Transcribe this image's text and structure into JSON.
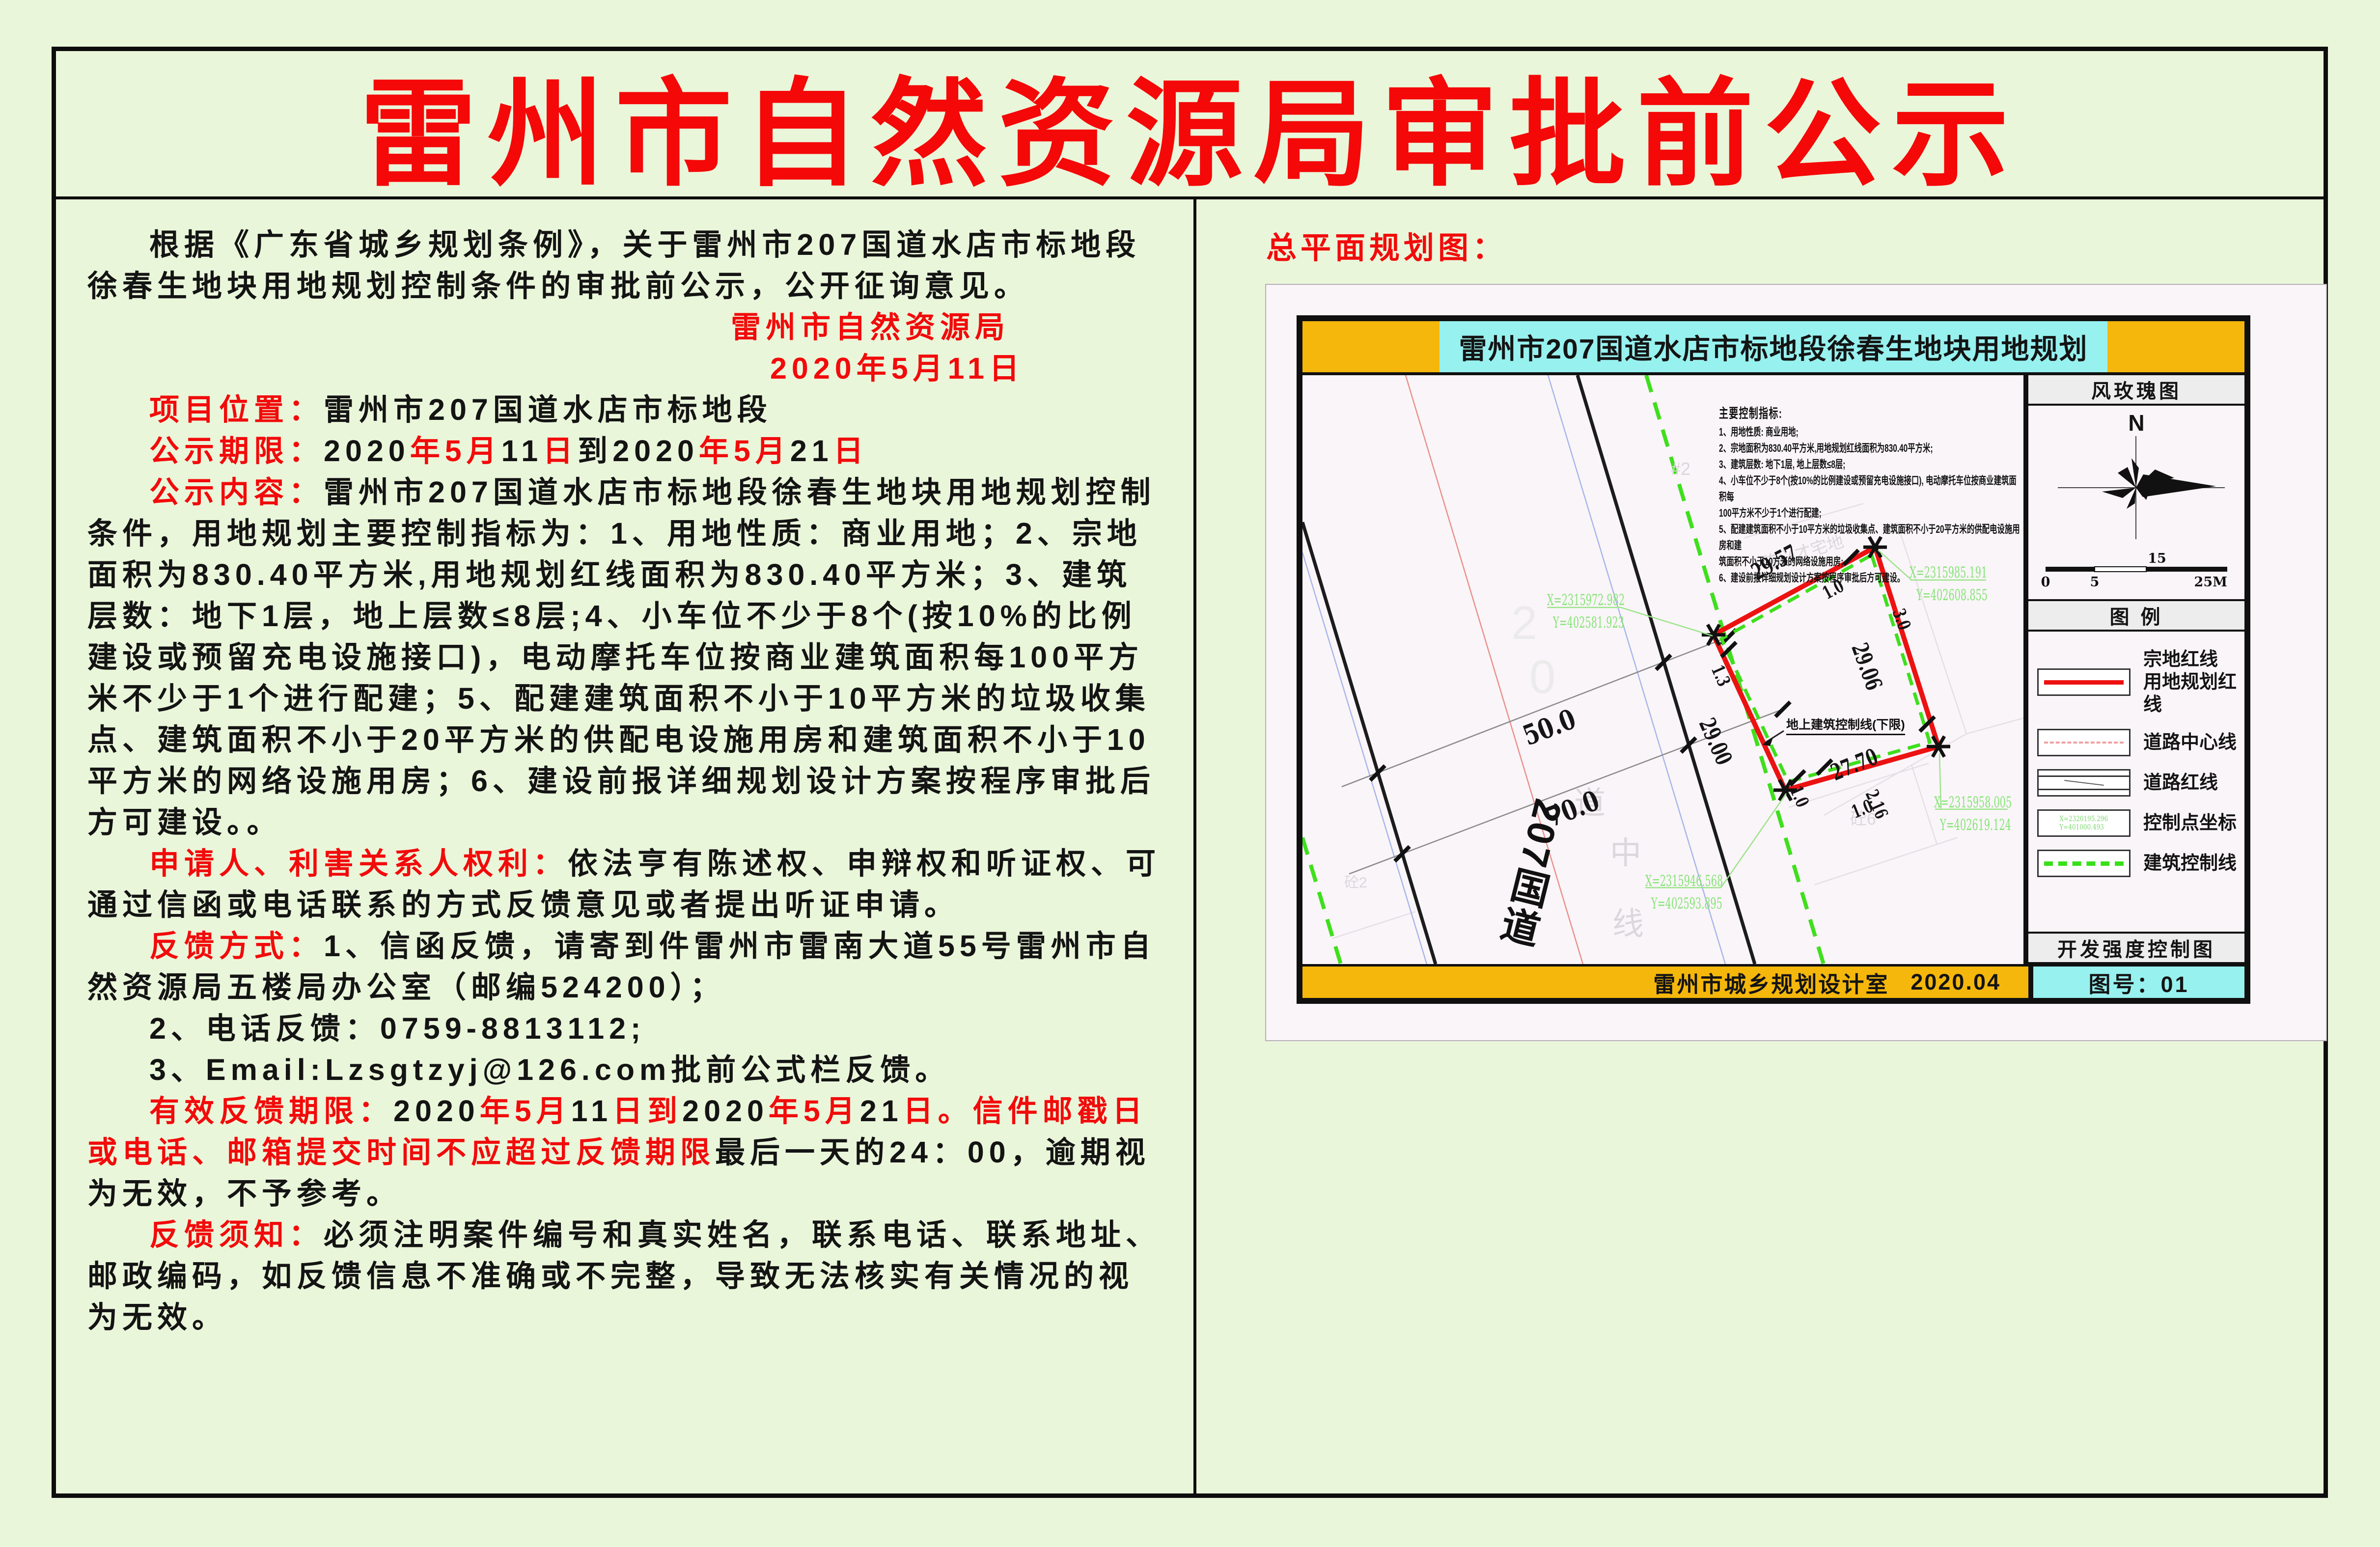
{
  "page": {
    "bg": "#eaf6da",
    "red": "#f20b0b",
    "title": "雷州市自然资源局审批前公示"
  },
  "left": {
    "p1": [
      {
        "t": "根据《广东省城乡规划条例》，关于雷州市207国道水店市标地段徐春生地块用地规划控制条件的审批前公示，公开征询意见。"
      }
    ],
    "sign1": [
      {
        "t": "雷州市自然资源局",
        "c": "r"
      }
    ],
    "sign2": [
      {
        "t": "2020年5月11日",
        "c": "r"
      }
    ],
    "p_location": [
      {
        "t": "项目位置：",
        "c": "r"
      },
      {
        "t": "雷州市207国道水店市标地段"
      }
    ],
    "p_period": [
      {
        "t": "公示期限：",
        "c": "r"
      },
      {
        "t": "2020"
      },
      {
        "t": "年5月",
        "c": "r"
      },
      {
        "t": "11"
      },
      {
        "t": "日",
        "c": "r"
      },
      {
        "t": "到"
      },
      {
        "t": "2020"
      },
      {
        "t": "年5月",
        "c": "r"
      },
      {
        "t": "21"
      },
      {
        "t": "日",
        "c": "r"
      }
    ],
    "p_content": [
      {
        "t": "公示内容：",
        "c": "r"
      },
      {
        "t": "雷州市207国道水店市标地段徐春生地块用地规划控制条件，用地规划主要控制指标为：1、用地性质：商业用地；2、宗地面积为830.40平方米,用地规划红线面积为830.40平方米；3、建筑层数：地下1层，地上层数≤8层;4、小车位不少于8个(按10%的比例建设或预留充电设施接口)，电动摩托车位按商业建筑面积每100平方米不少于1个进行配建；5、配建建筑面积不小于10平方米的垃圾收集点、建筑面积不小于20平方米的供配电设施用房和建筑面积不小于10平方米的网络设施用房；6、建设前报详细规划设计方案按程序审批后方可建设。。"
      }
    ],
    "p_rights": [
      {
        "t": "申请人、利害关系人权利：",
        "c": "r"
      },
      {
        "t": "依法亨有陈述权、申辩权和听证权、可通过信函或电话联系的方式反馈意见或者提出听证申请。"
      }
    ],
    "p_feedback": [
      {
        "t": "反馈方式：",
        "c": "r"
      },
      {
        "t": "1、信函反馈，请寄到件雷州市雷南大道55号雷州市自然资源局五楼局办公室（邮编524200）；"
      }
    ],
    "p_phone": [
      {
        "t": "2、电话反馈：0759-8813112;"
      }
    ],
    "p_email": [
      {
        "t": "3、Email:Lzsgtzyj@126.com批前公式栏反馈。"
      }
    ],
    "p_deadline": [
      {
        "t": "有效反馈期限：",
        "c": "r"
      },
      {
        "t": "2020"
      },
      {
        "t": "年5月",
        "c": "r"
      },
      {
        "t": "11"
      },
      {
        "t": "日到",
        "c": "r"
      },
      {
        "t": "2020"
      },
      {
        "t": "年5月",
        "c": "r"
      },
      {
        "t": "21"
      },
      {
        "t": "日。信件邮戳日或电话、邮箱提交时间不应超过反馈期限",
        "c": "r"
      },
      {
        "t": "最后一天的24：00，逾期视为无效，不予参考。"
      }
    ],
    "p_notice": [
      {
        "t": "反馈须知：",
        "c": "r"
      },
      {
        "t": "必须注明案件编号和真实姓名，联系电话、联系地址、邮政编码，如反馈信息不准确或不完整，导致无法核实有关情况的视为无效。"
      }
    ]
  },
  "map": {
    "section_title": "总平面规划图：",
    "title": "雷州市207国道水店市标地段徐春生地块用地规划",
    "footer": {
      "org": "雷州市城乡规划设计室",
      "date": "2020.04"
    },
    "sidebar": {
      "windrose_title": "风玫瑰图",
      "north": "N",
      "scale_labels": [
        "0",
        "5",
        "15",
        "25M"
      ],
      "legend_title": "图 例",
      "items": [
        {
          "label1": "宗地红线",
          "label2": "用地规划红线"
        },
        {
          "label": "道路中心线"
        },
        {
          "label": "道路红线"
        },
        {
          "label": "控制点坐标",
          "sx": "X=2320195.296",
          "sy": "Y=401000.493"
        },
        {
          "label": "建筑控制线"
        }
      ],
      "dev_title": "开发强度控制图",
      "sheet_no": "图号：01"
    },
    "notes": {
      "title": "主要控制指标:",
      "lines": [
        "1、用地性质: 商业用地;",
        "2、宗地面积为830.40平方米,用地规划红线面积为830.40平方米;",
        "3、建筑层数: 地下1层, 地上层数≤8层;",
        "4、小车位不少于8个(按10%的比例建设或预留充电设施接口), 电动摩托车位按商业建筑面积每",
        "100平方米不少于1个进行配建;",
        "5、配建建筑面积不小于10平方米的垃圾收集点、建筑面积不小于20平方米的供配电设施用房和建",
        "筑面积不小于10方米的网络设施用房;",
        "6、建设前报详细规划设计方案按程序审批后方可建设。"
      ]
    },
    "drawing": {
      "road_name": "207国道",
      "w50": "50.0",
      "w70": "70.0",
      "control_label": "地上建筑控制线(下限)",
      "dims": {
        "d2957": "29.57",
        "d2906": "29.06",
        "d2900": "29.00",
        "d2770": "27.70",
        "o10a": "1.0",
        "o30": "3.0",
        "o13": "1.3",
        "o10b": "1.0",
        "o10c": "1.0",
        "o216": "2.16"
      },
      "coords": {
        "tx": "X=2315985.191",
        "ty": "Y=402608.855",
        "rx": "X=2315958.005",
        "ry": "Y=402619.124",
        "lx": "X=2315972.982",
        "ly": "Y=402581.923",
        "bx": "X=2315946.568",
        "by": "Y=402593.895"
      },
      "ghosts": {
        "g1": "陈兴才宅地",
        "g2": "道",
        "g3": "中",
        "g4": "线",
        "g5": "砼6",
        "g6": "砼2",
        "g7": "#2",
        "g8": "2",
        "g9": "0"
      }
    }
  }
}
